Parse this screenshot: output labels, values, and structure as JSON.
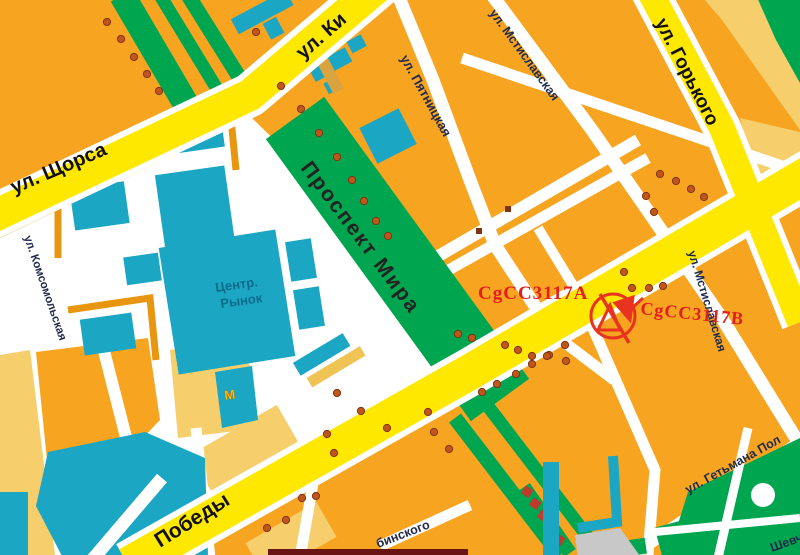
{
  "map": {
    "labels": {
      "kyivska": "ул. Ки",
      "shchorsa": "ул. Щорса",
      "komsomolska": "ул. Комсомольская",
      "mira": "Проспект Мира",
      "pyatnitska": "ул. Пятницкая",
      "mstislavska_top": "ул. Мстиславская",
      "mstislavska_right": "ул. Мстиславская",
      "gorkogo": "ул. Горького",
      "pobedy": "Победы",
      "getmana": "ул. Гетьмана Пол",
      "binskogo": "бинского",
      "shevchenko": "Шевч",
      "market_line1": "Центр.",
      "market_line2": "Рынок",
      "metro": "М"
    },
    "markers": {
      "site_a": "CgCC3117A",
      "site_b": "CgCC3117B"
    },
    "colors": {
      "block_orange": "#F7A421",
      "block_pale": "#F6CE6B",
      "road_yellow": "#FFE800",
      "street_white": "#FFFFFF",
      "green": "#00A550",
      "building_teal": "#1BA6C4",
      "wall_orange": "#E8960F",
      "dot": "#C1561C",
      "dot_border": "#7E3511",
      "marker_red": "#E31E1E",
      "gray": "#C8C8C8"
    },
    "dots": [
      [
        107,
        22
      ],
      [
        121,
        39
      ],
      [
        134,
        57
      ],
      [
        147,
        74
      ],
      [
        159,
        91
      ],
      [
        256,
        32
      ],
      [
        281,
        86
      ],
      [
        301,
        109
      ],
      [
        319,
        133
      ],
      [
        337,
        157
      ],
      [
        352,
        180
      ],
      [
        364,
        201
      ],
      [
        376,
        221
      ],
      [
        388,
        236
      ],
      [
        337,
        393
      ],
      [
        361,
        411
      ],
      [
        387,
        428
      ],
      [
        428,
        412
      ],
      [
        434,
        432
      ],
      [
        449,
        449
      ],
      [
        458,
        334
      ],
      [
        472,
        338
      ],
      [
        565,
        345
      ],
      [
        549,
        355
      ],
      [
        532,
        364
      ],
      [
        516,
        374
      ],
      [
        497,
        384
      ],
      [
        482,
        392
      ],
      [
        505,
        345
      ],
      [
        518,
        350
      ],
      [
        532,
        356
      ],
      [
        547,
        356
      ],
      [
        566,
        361
      ],
      [
        302,
        498
      ],
      [
        316,
        496
      ],
      [
        286,
        520
      ],
      [
        267,
        528
      ],
      [
        327,
        434
      ],
      [
        334,
        453
      ],
      [
        660,
        174
      ],
      [
        676,
        181
      ],
      [
        691,
        189
      ],
      [
        704,
        197
      ],
      [
        646,
        196
      ],
      [
        654,
        212
      ],
      [
        624,
        272
      ],
      [
        632,
        288
      ],
      [
        649,
        288
      ],
      [
        663,
        286
      ]
    ],
    "squares": [
      [
        508,
        209
      ],
      [
        479,
        231
      ]
    ]
  }
}
